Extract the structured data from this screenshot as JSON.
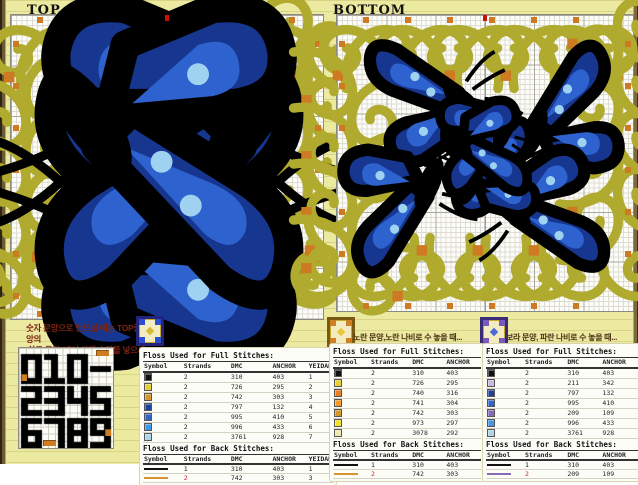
{
  "charts": [
    {
      "title": "TOP",
      "subtitle": "(w 60 x h 60)",
      "grid_cols": 60,
      "grid_rows": 60,
      "butterflies": [
        {
          "x": 82,
          "y": 94,
          "s": 1.2,
          "fx": false,
          "fy": false,
          "rot": 0
        },
        {
          "x": 234,
          "y": 94,
          "s": 1.2,
          "fx": true,
          "fy": false,
          "rot": 0
        },
        {
          "x": 82,
          "y": 240,
          "s": 1.2,
          "fx": false,
          "fy": true,
          "rot": 0
        },
        {
          "x": 234,
          "y": 240,
          "s": 1.2,
          "fx": true,
          "fy": true,
          "rot": 0
        }
      ],
      "hearts": [
        {
          "x": 128,
          "y": 128,
          "s": 0.52,
          "fx": false,
          "fy": false
        },
        {
          "x": 184,
          "y": 128,
          "s": 0.52,
          "fx": true,
          "fy": false
        },
        {
          "x": 128,
          "y": 180,
          "s": 0.52,
          "fx": false,
          "fy": true
        },
        {
          "x": 184,
          "y": 180,
          "s": 0.52,
          "fx": true,
          "fy": true
        }
      ]
    },
    {
      "title": "BOTTOM",
      "subtitle": "",
      "grid_cols": 60,
      "grid_rows": 60,
      "butterflies": [
        {
          "x": 54,
          "y": 46,
          "s": 0.52,
          "fx": false,
          "fy": false,
          "rot": -12
        },
        {
          "x": 246,
          "y": 50,
          "s": 0.52,
          "fx": true,
          "fy": false,
          "rot": 12
        },
        {
          "x": 42,
          "y": 238,
          "s": 0.52,
          "fx": false,
          "fy": true,
          "rot": 12
        },
        {
          "x": 246,
          "y": 236,
          "s": 0.52,
          "fx": true,
          "fy": true,
          "rot": -12
        },
        {
          "x": 124,
          "y": 120,
          "s": 0.4,
          "fx": false,
          "fy": false,
          "rot": -8
        },
        {
          "x": 176,
          "y": 120,
          "s": 0.4,
          "fx": true,
          "fy": false,
          "rot": 8
        },
        {
          "x": 126,
          "y": 164,
          "s": 0.4,
          "fx": false,
          "fy": true,
          "rot": 8
        },
        {
          "x": 174,
          "y": 164,
          "s": 0.4,
          "fx": true,
          "fy": true,
          "rot": -8
        }
      ],
      "hearts": []
    }
  ],
  "note": {
    "line1": "숫자 문양으로 만드실 때는 TOP중앙의",
    "line2": "'하트 문양' 대신 아래 숫자를 넣으세요!"
  },
  "digit_panel": {
    "lines": [
      "010-",
      "2345",
      "6789"
    ]
  },
  "preview_icons": [
    {
      "border": "#23237a",
      "corner": "#2b4fd0",
      "center": "#d8b830"
    },
    {
      "border": "#7a5a10",
      "corner": "#d08024",
      "center": "#e8c838"
    },
    {
      "border": "#3a2a7a",
      "corner": "#7a5ab8",
      "center": "#4a6ad8"
    }
  ],
  "palettes": [
    {
      "caption": "",
      "full_title": "Floss Used for Full Stitches:",
      "back_title": "Floss Used for Back Stitches:",
      "columns": [
        "Symbol",
        "Strands",
        "DMC",
        "ANCHOR",
        "YEIDAM"
      ],
      "full_rows": [
        {
          "color": "#111111",
          "strands": "2",
          "dmc": "310",
          "anchor": "403",
          "yeidam": "1"
        },
        {
          "color": "#e8cf3a",
          "strands": "2",
          "dmc": "726",
          "anchor": "295",
          "yeidam": "2"
        },
        {
          "color": "#d6952f",
          "strands": "2",
          "dmc": "742",
          "anchor": "303",
          "yeidam": "3"
        },
        {
          "color": "#1e3f9e",
          "strands": "2",
          "dmc": "797",
          "anchor": "132",
          "yeidam": "4"
        },
        {
          "color": "#2e66c8",
          "strands": "2",
          "dmc": "995",
          "anchor": "410",
          "yeidam": "5"
        },
        {
          "color": "#3f97e8",
          "strands": "2",
          "dmc": "996",
          "anchor": "433",
          "yeidam": "6"
        },
        {
          "color": "#acd6e8",
          "strands": "2",
          "dmc": "3761",
          "anchor": "928",
          "yeidam": "7"
        }
      ],
      "back_rows": [
        {
          "color": "#111111",
          "strands": "1",
          "dmc": "310",
          "anchor": "403",
          "yeidam": "1",
          "red": false
        },
        {
          "color": "#d6952f",
          "strands": "2",
          "dmc": "742",
          "anchor": "303",
          "yeidam": "3",
          "red": true
        }
      ]
    },
    {
      "caption": "노란 문양,노란 나비로 수 놓을 때...",
      "full_title": "Floss Used for Full Stitches:",
      "back_title": "Floss Used for Back Stitches:",
      "columns": [
        "Symbol",
        "Strands",
        "DMC",
        "ANCHOR"
      ],
      "full_rows": [
        {
          "color": "#111111",
          "strands": "2",
          "dmc": "310",
          "anchor": "403"
        },
        {
          "color": "#e8cf3a",
          "strands": "2",
          "dmc": "726",
          "anchor": "295"
        },
        {
          "color": "#ef7d24",
          "strands": "2",
          "dmc": "740",
          "anchor": "316"
        },
        {
          "color": "#f29b2c",
          "strands": "2",
          "dmc": "741",
          "anchor": "304"
        },
        {
          "color": "#d6952f",
          "strands": "2",
          "dmc": "742",
          "anchor": "303"
        },
        {
          "color": "#f2dd30",
          "strands": "2",
          "dmc": "973",
          "anchor": "297"
        },
        {
          "color": "#eee9ae",
          "strands": "2",
          "dmc": "3078",
          "anchor": "292"
        }
      ],
      "back_rows": [
        {
          "color": "#111111",
          "strands": "1",
          "dmc": "310",
          "anchor": "403",
          "red": false
        },
        {
          "color": "#d6952f",
          "strands": "2",
          "dmc": "742",
          "anchor": "303",
          "red": true
        }
      ]
    },
    {
      "caption": "보라 문양, 파란 나비로 수 놓을 때...",
      "full_title": "Floss Used for Full Stitches:",
      "back_title": "Floss Used for Back Stitches:",
      "columns": [
        "Symbol",
        "Strands",
        "DMC",
        "ANCHOR"
      ],
      "full_rows": [
        {
          "color": "#111111",
          "strands": "2",
          "dmc": "310",
          "anchor": "403"
        },
        {
          "color": "#cbb8de",
          "strands": "2",
          "dmc": "211",
          "anchor": "342"
        },
        {
          "color": "#1e3f9e",
          "strands": "2",
          "dmc": "797",
          "anchor": "132"
        },
        {
          "color": "#2e66c8",
          "strands": "2",
          "dmc": "995",
          "anchor": "410"
        },
        {
          "color": "#8a68b8",
          "strands": "2",
          "dmc": "209",
          "anchor": "109"
        },
        {
          "color": "#3f97e8",
          "strands": "2",
          "dmc": "996",
          "anchor": "433"
        },
        {
          "color": "#acd6e8",
          "strands": "2",
          "dmc": "3761",
          "anchor": "928"
        }
      ],
      "back_rows": [
        {
          "color": "#111111",
          "strands": "1",
          "dmc": "310",
          "anchor": "403",
          "red": false
        },
        {
          "color": "#8a68b8",
          "strands": "2",
          "dmc": "209",
          "anchor": "109",
          "red": true
        }
      ]
    }
  ],
  "colors": {
    "scroll": "#b0ab2e",
    "scroll_accent": "#cd7a22",
    "heart_fill": "#efe9a8",
    "bfly_dark": "#16368f",
    "bfly_mid": "#2d62cf",
    "bfly_light": "#9fd2f0",
    "red_marker": "#cc1100",
    "note_text": "#7c2310",
    "caption_text": "#4a3113"
  }
}
